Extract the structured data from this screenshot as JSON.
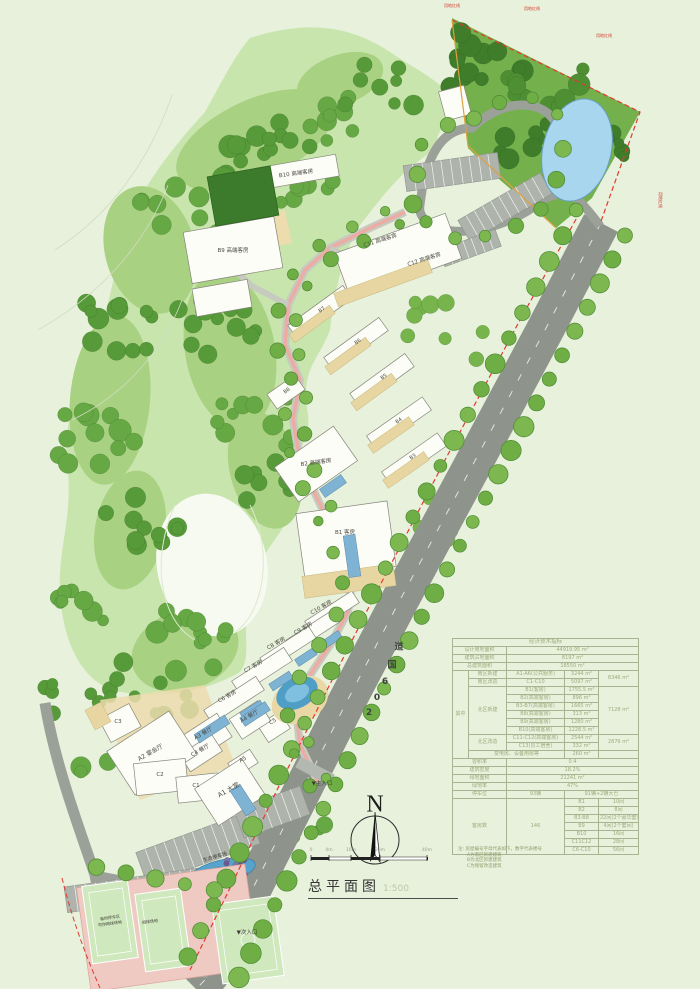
{
  "palette": {
    "background": "#e7f1dc",
    "forest_light": "#c9e5ae",
    "forest_mid": "#a9d182",
    "forest_dark": "#579a39",
    "road_gray": "#8e938c",
    "boundary_red": "#e23b2e",
    "boundary_orange": "#dfa041",
    "water_blue": "#a8d6ee",
    "deck_tan": "#ecdcae",
    "building_white": "#fdfdf7"
  },
  "legend": {
    "north": "N"
  },
  "scale_bar": {
    "ticks": [
      "0",
      "4m",
      "10m",
      "20m",
      "40m"
    ]
  },
  "title": {
    "text": "总平面图",
    "scale": "1:500"
  },
  "road": {
    "name": "206国道",
    "chars": [
      {
        "ch": "2",
        "x": 369,
        "y": 713
      },
      {
        "ch": "0",
        "x": 377,
        "y": 698
      },
      {
        "ch": "6",
        "x": 385,
        "y": 682
      },
      {
        "ch": "国",
        "x": 392,
        "y": 664
      },
      {
        "ch": "道",
        "x": 399,
        "y": 646
      }
    ]
  },
  "map_labels": {
    "buildings": [
      {
        "label": "B10 高端客房",
        "x": 296,
        "y": 173,
        "rot": -8
      },
      {
        "label": "B9 高端客房",
        "x": 233,
        "y": 250,
        "rot": 0
      },
      {
        "label": "C11 高端客房",
        "x": 380,
        "y": 240,
        "rot": -18
      },
      {
        "label": "C12 高端客房",
        "x": 424,
        "y": 259,
        "rot": -18
      },
      {
        "label": "B7",
        "x": 322,
        "y": 310,
        "rot": -35,
        "fs": 5
      },
      {
        "label": "B6",
        "x": 358,
        "y": 342,
        "rot": -35,
        "fs": 5
      },
      {
        "label": "B5",
        "x": 384,
        "y": 377,
        "rot": -35,
        "fs": 5
      },
      {
        "label": "B4",
        "x": 399,
        "y": 421,
        "rot": -35,
        "fs": 5
      },
      {
        "label": "B3",
        "x": 413,
        "y": 457,
        "rot": -35,
        "fs": 5
      },
      {
        "label": "B8",
        "x": 287,
        "y": 391,
        "rot": -35,
        "fs": 5
      },
      {
        "label": "B2 高端客房",
        "x": 316,
        "y": 462,
        "rot": -8
      },
      {
        "label": "B1 客房",
        "x": 345,
        "y": 532,
        "rot": 0
      },
      {
        "label": "C10 客房",
        "x": 321,
        "y": 607,
        "rot": -30
      },
      {
        "label": "C9 客房",
        "x": 303,
        "y": 628,
        "rot": -30
      },
      {
        "label": "C8 客房",
        "x": 276,
        "y": 643,
        "rot": -30
      },
      {
        "label": "C7 客房",
        "x": 253,
        "y": 666,
        "rot": -30
      },
      {
        "label": "C6 客房",
        "x": 227,
        "y": 696,
        "rot": -30
      },
      {
        "label": "C5",
        "x": 273,
        "y": 722,
        "rot": -30
      },
      {
        "label": "A4 餐厅",
        "x": 249,
        "y": 716,
        "rot": -30
      },
      {
        "label": "A5",
        "x": 243,
        "y": 760,
        "rot": -30
      },
      {
        "label": "A3 餐厅",
        "x": 203,
        "y": 733,
        "rot": -30
      },
      {
        "label": "C4 餐厅",
        "x": 200,
        "y": 750,
        "rot": -30
      },
      {
        "label": "A2 宴会厅",
        "x": 150,
        "y": 752,
        "rot": -30,
        "fs": 6
      },
      {
        "label": "C3",
        "x": 118,
        "y": 722,
        "rot": 0
      },
      {
        "label": "C2",
        "x": 160,
        "y": 775,
        "rot": 0
      },
      {
        "label": "C1",
        "x": 196,
        "y": 786,
        "rot": 0
      },
      {
        "label": "A1 大堂",
        "x": 228,
        "y": 789,
        "rot": -30,
        "fs": 6.5
      }
    ],
    "site": [
      {
        "label": "生态停车场",
        "x": 215,
        "y": 857,
        "rot": -16
      },
      {
        "label": "临时停车区",
        "x": 110,
        "y": 918,
        "rot": -8,
        "fs": 4
      },
      {
        "label": "可作网球场地",
        "x": 110,
        "y": 924,
        "rot": -8,
        "fs": 4
      },
      {
        "label": "网球场地",
        "x": 150,
        "y": 922,
        "rot": -8,
        "fs": 4
      },
      {
        "label": "▼主入口",
        "x": 322,
        "y": 783,
        "fs": 5.5
      },
      {
        "label": "▼次入口",
        "x": 247,
        "y": 932,
        "fs": 5.5
      }
    ],
    "boundary": [
      {
        "label": "用地红线",
        "x": 452,
        "y": 6
      },
      {
        "label": "用地红线",
        "x": 532,
        "y": 9
      },
      {
        "label": "用地红线",
        "x": 604,
        "y": 36
      },
      {
        "label": "用地红线",
        "x": 660,
        "y": 200,
        "rot": 90
      }
    ]
  },
  "table": {
    "title": "经济技术指标",
    "land_area_label": "设计用地面积",
    "land_area": "44919.95 m²",
    "footprint_label": "建筑占地面积",
    "footprint": "8197 m²",
    "gfa_label": "总建筑面积",
    "gfa": "18550 m²",
    "among_label": "其中",
    "south_new_label": "南区新建",
    "south_new_item": "A1-A6(公共服务)",
    "south_new_val": "3244 m²",
    "south_reno_label": "南区改造",
    "south_reno_item": "C1-C10",
    "south_reno_val": "5097 m²",
    "south_subtotal": "8346 m²",
    "north_new_label": "北区新建",
    "north_new_items": [
      [
        "B1(客房)",
        "1755.5 m²"
      ],
      [
        "B2(高端客房)",
        "896 m²"
      ],
      [
        "B3-B7(高端客房)",
        "1665 m²"
      ],
      [
        "B8(高端客房)",
        "313 m²"
      ],
      [
        "B9(高端客房)",
        "1280 m²"
      ],
      [
        "B10(高端客房)",
        "1228.5 m²"
      ]
    ],
    "north_subtotal": "7128 m²",
    "north_reno_label": "北区改造",
    "north_reno_items": [
      [
        "C11-C12(高端客房)",
        "2544 m²"
      ],
      [
        "C13(员工宿舍)",
        "332 m²"
      ]
    ],
    "north_reno_subtotal": "2876 m²",
    "equip_label": "变电房、设备用房等",
    "equip_val": "260 m²",
    "far_label": "容积率",
    "far": "0.4",
    "density_label": "建筑密度",
    "density": "18.2%",
    "green_area_label": "绿地面积",
    "green_area": "21241 m²",
    "green_rate_label": "绿地率",
    "green_rate": "47%",
    "parking_label": "停车位",
    "parking_count": "93辆",
    "parking_detail": "91辆+2辆大巴",
    "rooms_label": "客房数",
    "rooms_total": "146",
    "rooms_items": [
      [
        "B1",
        "10间"
      ],
      [
        "B2",
        "8间"
      ],
      [
        "B3-B8",
        "22间(2个豪华套间)"
      ],
      [
        "B9",
        "4间(2个套间)"
      ],
      [
        "B10",
        "16间"
      ],
      [
        "C11C12",
        "28间"
      ],
      [
        "C6-C10",
        "56间"
      ]
    ]
  },
  "notes": {
    "line1": "注: 房屋编号字母代表如下。数字代表楼号",
    "line2": "A为南区新建建筑",
    "line3": "B为北区新建建筑",
    "line4": "C为保留改造建筑"
  }
}
